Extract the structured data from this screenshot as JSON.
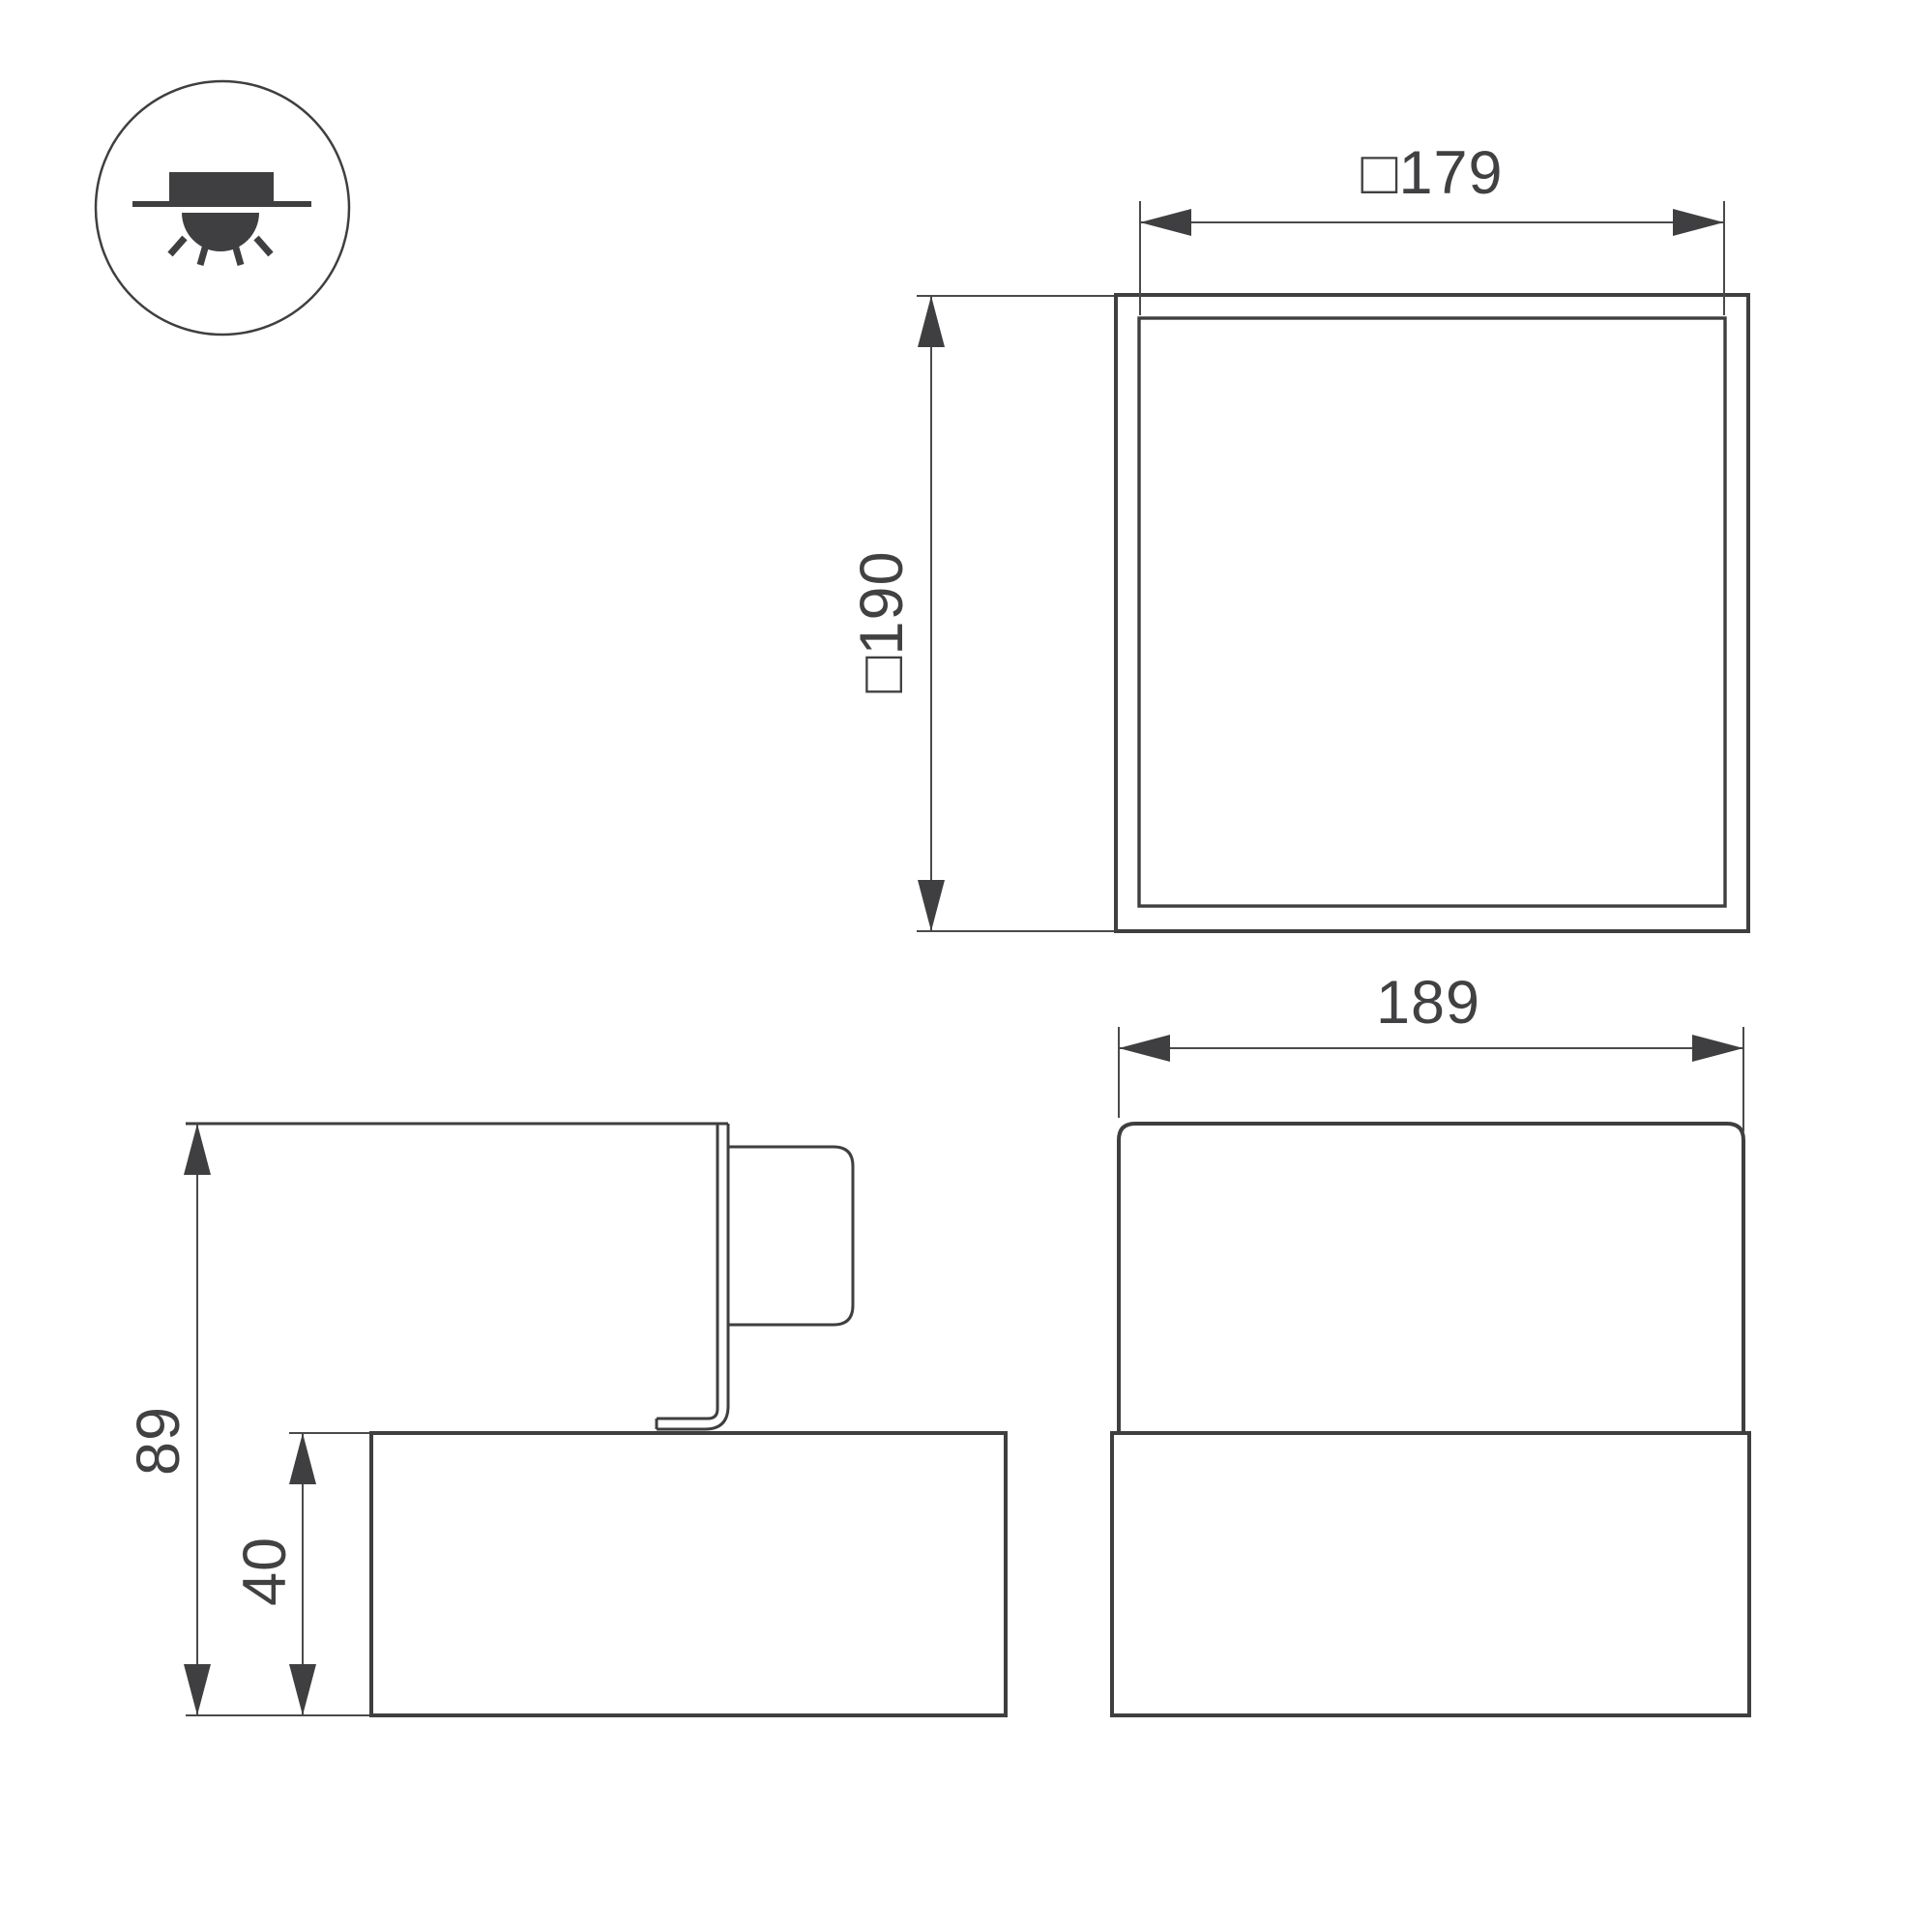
{
  "colors": {
    "line": "#3f3f41",
    "dimension_line": "#4a4a4d",
    "text": "#414144",
    "background": "#ffffff"
  },
  "icon": {
    "name": "recessed-ceiling-light-icon"
  },
  "dimensions": {
    "top_view_width_label": "□179",
    "top_view_height_label": "□190",
    "front_view_width_label": "189",
    "side_view_total_height_label": "89",
    "side_view_body_height_label": "40"
  }
}
